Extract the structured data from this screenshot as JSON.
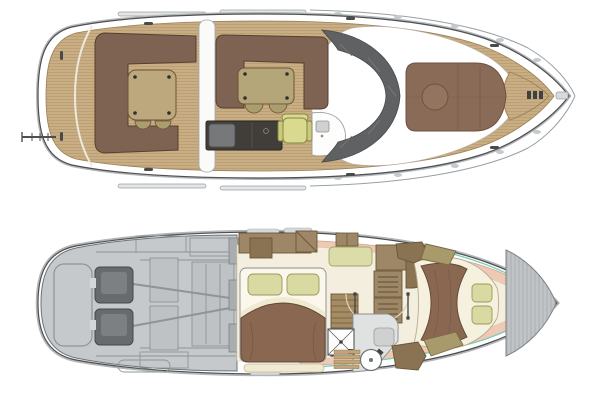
{
  "colors": {
    "background": "#ffffff",
    "ink": "#4d4f50",
    "line_soft": "#9aa0a2",
    "teak": "#c9ad83",
    "teak_seam": "#8a6f47",
    "teak_margin": "#9b7f57",
    "sofa_brown": "#7e6252",
    "sofa_brown_dark": "#57402f",
    "table_wood": "#bda77c",
    "table_tan": "#b4a678",
    "stool_tan": "#ac9d6e",
    "helm_green": "#d9d98f",
    "helm_green_dark": "#85853f",
    "galley_dark": "#413d39",
    "appliance_gray": "#77787a",
    "console_white": "#fdfdfc",
    "windshield": "#5f6163",
    "windshield_hatch": "#7b7d7f",
    "sunpad_brown": "#8a6b57",
    "sunpad_seam": "#6d5241",
    "engine_room": "#c6c9cb",
    "engine_room_line": "#8f9496",
    "engine_block": "#686b6d",
    "engine_block_line": "#45484a",
    "bulkhead_gray": "#a9adaf",
    "floor_cream": "#f4eede",
    "liner_salmon": "#eecab5",
    "liner_salmon_line": "#c9a48d",
    "bed_white": "#fbf7ec",
    "sheet_cream": "#f1ead3",
    "duvet_brown": "#8a6750",
    "duvet_line": "#5f4733",
    "pillow_green": "#d9daa2",
    "pillow_green_line": "#9a9a5e",
    "cabinet_brown": "#9d8766",
    "cabinet_brown_dark": "#8a7353",
    "cabinet_line": "#6b5637",
    "khaki": "#a89a6a",
    "khaki_line": "#7a6c42",
    "settee_green": "#dcdca8",
    "stair_wood": "#a58c64",
    "head_floor": "#e0e1e1",
    "sole_teak": "#c2a478",
    "bow_locker": "#b5b9bb",
    "bow_locker_line": "#7e8284",
    "accent_teal": "#7fccb9",
    "fitting_dark": "#3f4143",
    "door_arc": "#ddd3c0",
    "window_gray": "#d6d9da"
  },
  "main_deck": {
    "name": "main-deck-plan",
    "parts": [
      "swim-platform",
      "stern-ladder",
      "cockpit-sofa",
      "cockpit-table",
      "cockpit-stools",
      "walkway",
      "saloon-sofa",
      "saloon-table",
      "saloon-stools",
      "wet-bar",
      "refrigerator",
      "helm-seat",
      "helm-console",
      "sink",
      "windshield",
      "coachroof",
      "foredeck-sunpad",
      "sunpad-table",
      "foredeck-hatch",
      "anchor-windlass",
      "bow-roller",
      "bow-pulpit",
      "stanchions",
      "cleats",
      "grab-rails"
    ]
  },
  "lower_deck": {
    "name": "lower-deck-plan",
    "parts": [
      "engine-room",
      "port-engine",
      "starboard-engine",
      "propeller-shafts",
      "fuel-tank",
      "lazarette-locker",
      "engine-room-bulkhead",
      "mid-cabin-bed",
      "mid-cabin-pillows",
      "mid-cabin-bench",
      "wardrobe",
      "port-settee",
      "hanging-locker",
      "galley-counter",
      "galley-louver-units",
      "companionway-stairs",
      "door-swings",
      "shower",
      "toilet",
      "vanity",
      "teak-sole",
      "forward-berth",
      "forward-berth-cushions",
      "side-seats",
      "hull-liner",
      "hull-windows",
      "bow-locker",
      "waterline-accent"
    ]
  }
}
